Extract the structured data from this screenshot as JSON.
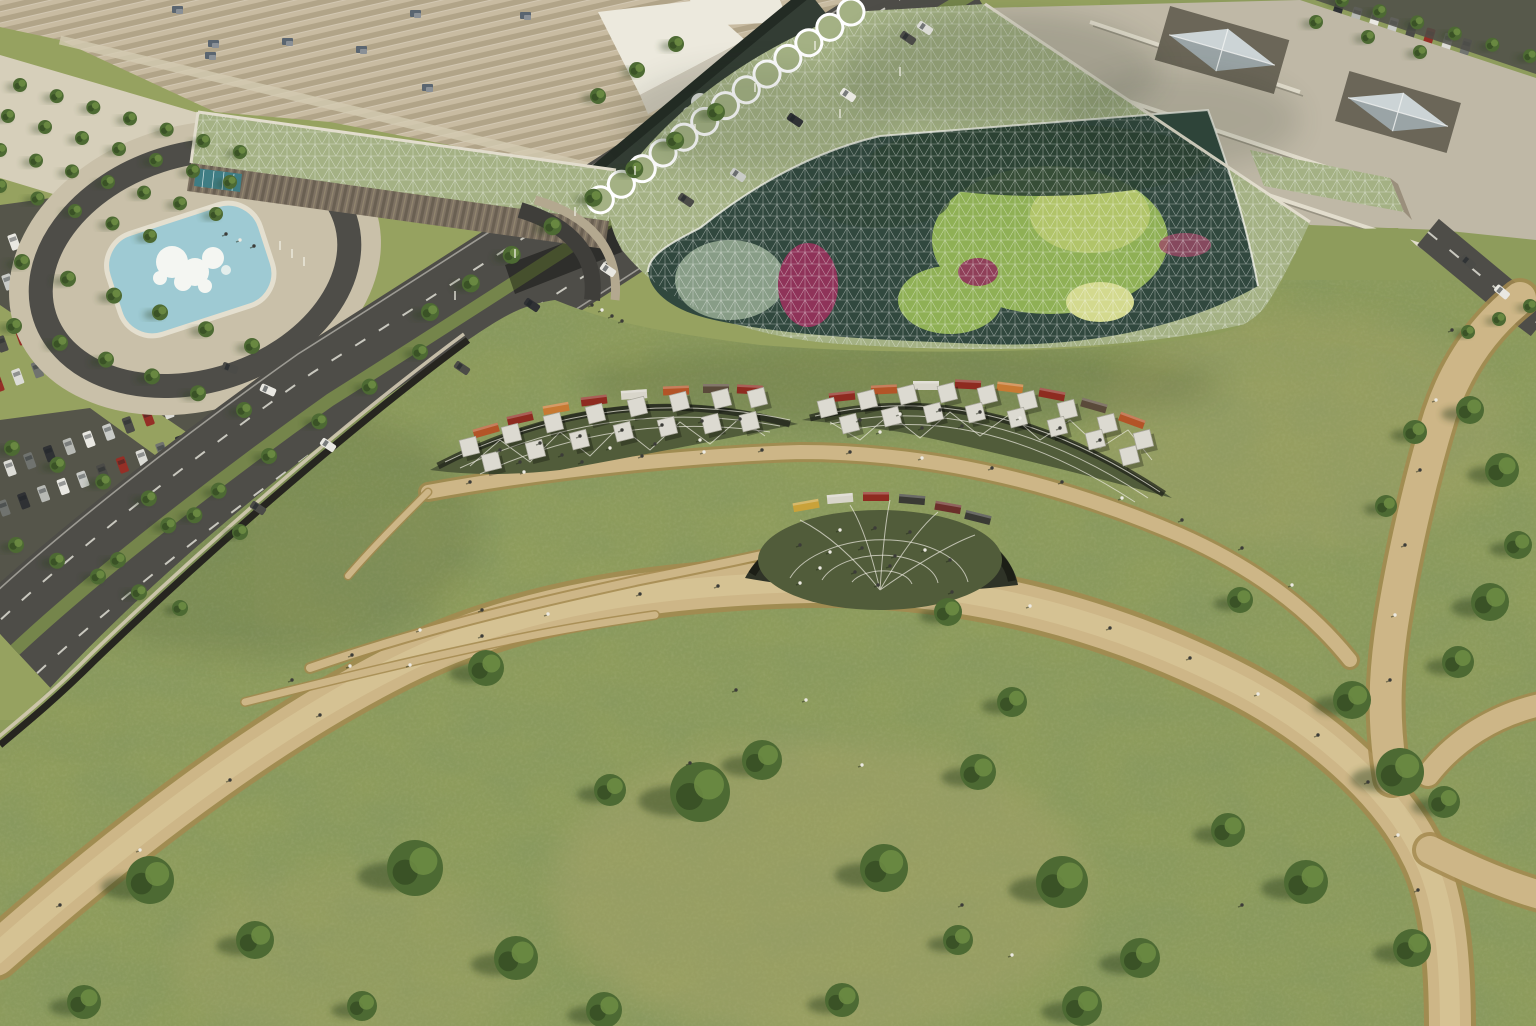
{
  "meta": {
    "description": "Aerial rendering: shopping-centre green roof park with glass gridshell garden, terraces, fountain, parking and roads"
  },
  "colors": {
    "grass": "#8e9c5c",
    "grassLight": "#9ba763",
    "grassDark": "#75854b",
    "dry": "#b3a871",
    "path": "#cdb687",
    "pathEdge": "#a3894f",
    "pathLight": "#e0d0a2",
    "stripeA": "#c8bba1",
    "stripeB": "#b1a488",
    "roofWhite": "#ece9dd",
    "roofSide": "#cfc9ba",
    "shell": "#a4b184",
    "glass": "#31483e",
    "palm": "#8fb055",
    "palmLight": "#b5c76b",
    "magenta": "#8f3359",
    "leafDark": "#2e4434",
    "canal": "#232b24",
    "canalLight": "#3a463c",
    "asphalt": "#4e4d48",
    "lane": "#e9e7dd",
    "plaza": "#c9c0a9",
    "plazaLight": "#d6cfba",
    "pool": "#9ecad3",
    "poolRim": "#e4dfcf",
    "foam": "#f4f6f2",
    "beigeRoof": "#bfb8a6",
    "parapet": "#e2ddcd",
    "parapetShadow": "#8f897a",
    "fascia": "#7e7263",
    "wall": "#26251f",
    "walkway": "#d3cab2",
    "terraceFloor": "#515c3a",
    "terraceDark": "#2f3327",
    "canopy": "#dcdad1",
    "canopyShade": "#a9a79c",
    "tree": "#4d6a33",
    "treeDark": "#3a5226",
    "treeLight": "#6f8d44",
    "treeShadow": "#2c401f",
    "teal": "#3f7d84",
    "person": "#3c3c38",
    "personLight": "#eceae2",
    "pyramid": "#ccd4d6",
    "pyramidSide": "#9aa4a6"
  },
  "scene": {
    "carColors": [
      "#e9e8e2",
      "#c9cbc7",
      "#4b4b47",
      "#952f26",
      "#dcdcd6",
      "#70736f",
      "#2f3134",
      "#b7b9b4"
    ],
    "trees": [
      [
        150,
        880,
        24
      ],
      [
        255,
        940,
        19
      ],
      [
        415,
        868,
        28
      ],
      [
        516,
        958,
        22
      ],
      [
        610,
        790,
        16
      ],
      [
        700,
        792,
        30
      ],
      [
        762,
        760,
        20
      ],
      [
        884,
        868,
        24
      ],
      [
        978,
        772,
        18
      ],
      [
        1062,
        882,
        26
      ],
      [
        1140,
        958,
        20
      ],
      [
        1228,
        830,
        17
      ],
      [
        1306,
        882,
        22
      ],
      [
        1412,
        948,
        19
      ],
      [
        84,
        1002,
        17
      ],
      [
        362,
        1006,
        15
      ],
      [
        604,
        1010,
        18
      ],
      [
        842,
        1000,
        17
      ],
      [
        1082,
        1006,
        20
      ],
      [
        958,
        940,
        15
      ],
      [
        1352,
        700,
        19
      ],
      [
        1400,
        772,
        24
      ],
      [
        1444,
        802,
        16
      ],
      [
        1240,
        600,
        13
      ],
      [
        1012,
        702,
        15
      ],
      [
        948,
        612,
        14
      ],
      [
        486,
        668,
        18
      ],
      [
        1470,
        410,
        14
      ],
      [
        1502,
        470,
        17
      ],
      [
        1518,
        545,
        14
      ],
      [
        1490,
        602,
        19
      ],
      [
        1458,
        662,
        16
      ],
      [
        1415,
        432,
        12
      ],
      [
        1386,
        506,
        11
      ]
    ],
    "treeLines": [
      {
        "p": [
          20,
          85,
          240,
          152
        ],
        "n": 7,
        "r": 7
      },
      {
        "p": [
          8,
          116,
          230,
          182
        ],
        "n": 7,
        "r": 7
      },
      {
        "p": [
          0,
          150,
          216,
          214
        ],
        "n": 7,
        "r": 7
      },
      {
        "p": [
          0,
          186,
          150,
          236
        ],
        "n": 5,
        "r": 7
      },
      {
        "p": [
          22,
          262,
          252,
          346
        ],
        "n": 6,
        "r": 8
      },
      {
        "p": [
          14,
          326,
          244,
          410
        ],
        "n": 6,
        "r": 8
      },
      {
        "p": [
          12,
          448,
          240,
          532
        ],
        "n": 6,
        "r": 8
      },
      {
        "p": [
          16,
          545,
          180,
          608
        ],
        "n": 5,
        "r": 8
      },
      {
        "p": [
          430,
          312,
          716,
          112
        ],
        "n": 8,
        "r": 9
      },
      {
        "p": [
          118,
          560,
          420,
          352
        ],
        "n": 7,
        "r": 8
      },
      {
        "p": [
          598,
          96,
          676,
          44
        ],
        "n": 3,
        "r": 8
      },
      {
        "p": [
          1342,
          0,
          1530,
          56
        ],
        "n": 6,
        "r": 7
      },
      {
        "p": [
          1316,
          22,
          1420,
          52
        ],
        "n": 3,
        "r": 7
      },
      {
        "p": [
          1468,
          332,
          1530,
          306
        ],
        "n": 3,
        "r": 7
      }
    ],
    "people": [
      [
        500,
        450,
        0
      ],
      [
        540,
        443,
        0
      ],
      [
        580,
        436,
        0
      ],
      [
        622,
        430,
        0
      ],
      [
        662,
        425,
        0
      ],
      [
        702,
        421,
        0
      ],
      [
        740,
        419,
        0
      ],
      [
        520,
        462,
        0
      ],
      [
        562,
        455,
        0
      ],
      [
        610,
        448,
        1
      ],
      [
        655,
        444,
        0
      ],
      [
        700,
        440,
        1
      ],
      [
        860,
        420,
        0
      ],
      [
        900,
        414,
        1
      ],
      [
        940,
        410,
        0
      ],
      [
        980,
        412,
        0
      ],
      [
        1020,
        418,
        1
      ],
      [
        1060,
        428,
        0
      ],
      [
        1100,
        440,
        0
      ],
      [
        880,
        432,
        1
      ],
      [
        922,
        428,
        0
      ],
      [
        962,
        426,
        0
      ],
      [
        800,
        545,
        0
      ],
      [
        830,
        552,
        1
      ],
      [
        862,
        548,
        0
      ],
      [
        895,
        556,
        0
      ],
      [
        925,
        550,
        1
      ],
      [
        950,
        560,
        0
      ],
      [
        820,
        568,
        1
      ],
      [
        855,
        572,
        0
      ],
      [
        890,
        566,
        0
      ],
      [
        840,
        530,
        1
      ],
      [
        875,
        528,
        0
      ],
      [
        910,
        532,
        0
      ],
      [
        60,
        905,
        0
      ],
      [
        140,
        850,
        1
      ],
      [
        230,
        780,
        0
      ],
      [
        320,
        715,
        0
      ],
      [
        410,
        665,
        1
      ],
      [
        482,
        636,
        0
      ],
      [
        548,
        614,
        1
      ],
      [
        640,
        594,
        0
      ],
      [
        718,
        586,
        0
      ],
      [
        800,
        583,
        1
      ],
      [
        878,
        585,
        0
      ],
      [
        952,
        592,
        0
      ],
      [
        1030,
        606,
        1
      ],
      [
        1110,
        628,
        0
      ],
      [
        1190,
        658,
        0
      ],
      [
        1258,
        694,
        1
      ],
      [
        1318,
        735,
        0
      ],
      [
        1368,
        782,
        0
      ],
      [
        1398,
        835,
        1
      ],
      [
        1418,
        890,
        0
      ],
      [
        470,
        482,
        0
      ],
      [
        524,
        472,
        1
      ],
      [
        582,
        462,
        0
      ],
      [
        642,
        456,
        0
      ],
      [
        704,
        452,
        1
      ],
      [
        762,
        450,
        0
      ],
      [
        850,
        452,
        0
      ],
      [
        922,
        458,
        1
      ],
      [
        992,
        468,
        0
      ],
      [
        1062,
        482,
        0
      ],
      [
        1122,
        498,
        1
      ],
      [
        1182,
        520,
        0
      ],
      [
        1242,
        548,
        0
      ],
      [
        1292,
        585,
        1
      ],
      [
        352,
        655,
        0
      ],
      [
        420,
        630,
        1
      ],
      [
        482,
        610,
        0
      ],
      [
        292,
        680,
        0
      ],
      [
        350,
        666,
        1
      ],
      [
        1452,
        330,
        0
      ],
      [
        1436,
        400,
        1
      ],
      [
        1420,
        470,
        0
      ],
      [
        1405,
        545,
        0
      ],
      [
        1395,
        615,
        1
      ],
      [
        1390,
        680,
        0
      ],
      [
        690,
        763,
        0
      ],
      [
        862,
        765,
        1
      ],
      [
        962,
        905,
        0
      ],
      [
        1242,
        905,
        0
      ],
      [
        1012,
        955,
        1
      ],
      [
        736,
        690,
        0
      ],
      [
        806,
        700,
        1
      ],
      [
        592,
        305,
        0
      ],
      [
        602,
        310,
        1
      ],
      [
        612,
        316,
        0
      ],
      [
        622,
        321,
        0
      ],
      [
        226,
        234,
        0
      ],
      [
        240,
        240,
        1
      ],
      [
        254,
        246,
        0
      ]
    ],
    "roadCars": [
      [
        908,
        38,
        34,
        2
      ],
      [
        848,
        95,
        34,
        0
      ],
      [
        795,
        120,
        34,
        6
      ],
      [
        738,
        175,
        34,
        1
      ],
      [
        686,
        200,
        34,
        2
      ],
      [
        608,
        270,
        34,
        0
      ],
      [
        532,
        305,
        34,
        6
      ],
      [
        462,
        368,
        34,
        2
      ],
      [
        328,
        445,
        34,
        0
      ],
      [
        258,
        508,
        34,
        2
      ],
      [
        925,
        28,
        34,
        4
      ],
      [
        230,
        368,
        20,
        2
      ],
      [
        268,
        390,
        24,
        0
      ],
      [
        1468,
        262,
        40,
        2
      ],
      [
        1502,
        292,
        40,
        0
      ]
    ],
    "carRows": [
      {
        "x": 14,
        "y": 242,
        "a": -20,
        "n": 12,
        "s": 21
      },
      {
        "x": 8,
        "y": 282,
        "a": -20,
        "n": 12,
        "s": 21
      },
      {
        "x": 2,
        "y": 344,
        "a": -20,
        "n": 11,
        "s": 21
      },
      {
        "x": -2,
        "y": 384,
        "a": -20,
        "n": 11,
        "s": 21
      },
      {
        "x": 10,
        "y": 468,
        "a": -20,
        "n": 12,
        "s": 21
      },
      {
        "x": 4,
        "y": 508,
        "a": -20,
        "n": 12,
        "s": 21
      },
      {
        "x": 1338,
        "y": 10,
        "a": 16,
        "n": 8,
        "s": 19
      },
      {
        "x": 1362,
        "y": 38,
        "a": 16,
        "n": 9,
        "s": 19
      },
      {
        "x": 1390,
        "y": 66,
        "a": 16,
        "n": 8,
        "s": 19
      }
    ],
    "canopies": [
      [
        470,
        447
      ],
      [
        512,
        434
      ],
      [
        554,
        423
      ],
      [
        596,
        414
      ],
      [
        638,
        407
      ],
      [
        680,
        402
      ],
      [
        722,
        399
      ],
      [
        758,
        398
      ],
      [
        492,
        462
      ],
      [
        536,
        450
      ],
      [
        580,
        440
      ],
      [
        624,
        432
      ],
      [
        668,
        427
      ],
      [
        712,
        424
      ],
      [
        750,
        422
      ],
      [
        828,
        408
      ],
      [
        868,
        400
      ],
      [
        908,
        395
      ],
      [
        948,
        393
      ],
      [
        988,
        395
      ],
      [
        1028,
        401
      ],
      [
        1068,
        410
      ],
      [
        1108,
        424
      ],
      [
        1144,
        440
      ],
      [
        850,
        424
      ],
      [
        892,
        417
      ],
      [
        934,
        413
      ],
      [
        976,
        413
      ],
      [
        1018,
        418
      ],
      [
        1058,
        427
      ],
      [
        1096,
        440
      ],
      [
        1130,
        456
      ]
    ],
    "storefronts": [
      [
        486,
        430,
        -16,
        "#b35427"
      ],
      [
        520,
        418,
        -13,
        "#8e2b20"
      ],
      [
        556,
        408,
        -10,
        "#c77a33"
      ],
      [
        594,
        400,
        -7,
        "#8e2b20"
      ],
      [
        634,
        394,
        -4,
        "#d8d5ca"
      ],
      [
        676,
        390,
        -2,
        "#b35427"
      ],
      [
        716,
        388,
        0,
        "#5a4a3a"
      ],
      [
        750,
        389,
        3,
        "#8e2b20"
      ],
      [
        842,
        396,
        -6,
        "#8e2b20"
      ],
      [
        884,
        389,
        -3,
        "#b35427"
      ],
      [
        926,
        385,
        0,
        "#d8d5ca"
      ],
      [
        968,
        384,
        3,
        "#8e2b20"
      ],
      [
        1010,
        387,
        7,
        "#c77a33"
      ],
      [
        1052,
        394,
        11,
        "#8e2b20"
      ],
      [
        1094,
        405,
        16,
        "#5a4a3a"
      ],
      [
        1132,
        420,
        20,
        "#b35427"
      ],
      [
        806,
        505,
        -10,
        "#c9a23a"
      ],
      [
        840,
        498,
        -5,
        "#d8d5ca"
      ],
      [
        876,
        496,
        0,
        "#8e2b20"
      ],
      [
        912,
        499,
        5,
        "#3a3a34"
      ],
      [
        948,
        507,
        10,
        "#6b2f2a"
      ],
      [
        978,
        517,
        14,
        "#3a3a34"
      ]
    ],
    "hvac": [
      [
        172,
        6
      ],
      [
        208,
        40
      ],
      [
        282,
        38
      ],
      [
        356,
        46
      ],
      [
        410,
        10
      ],
      [
        422,
        84
      ],
      [
        205,
        52
      ],
      [
        520,
        12
      ],
      [
        1112,
        44
      ],
      [
        1128,
        52
      ]
    ],
    "poles": [
      [
        455,
        300
      ],
      [
        515,
        258
      ],
      [
        575,
        216
      ],
      [
        635,
        175
      ],
      [
        695,
        133
      ],
      [
        755,
        92
      ],
      [
        815,
        50
      ],
      [
        280,
        250
      ],
      [
        292,
        258
      ],
      [
        304,
        266
      ],
      [
        840,
        118
      ],
      [
        900,
        76
      ]
    ]
  }
}
